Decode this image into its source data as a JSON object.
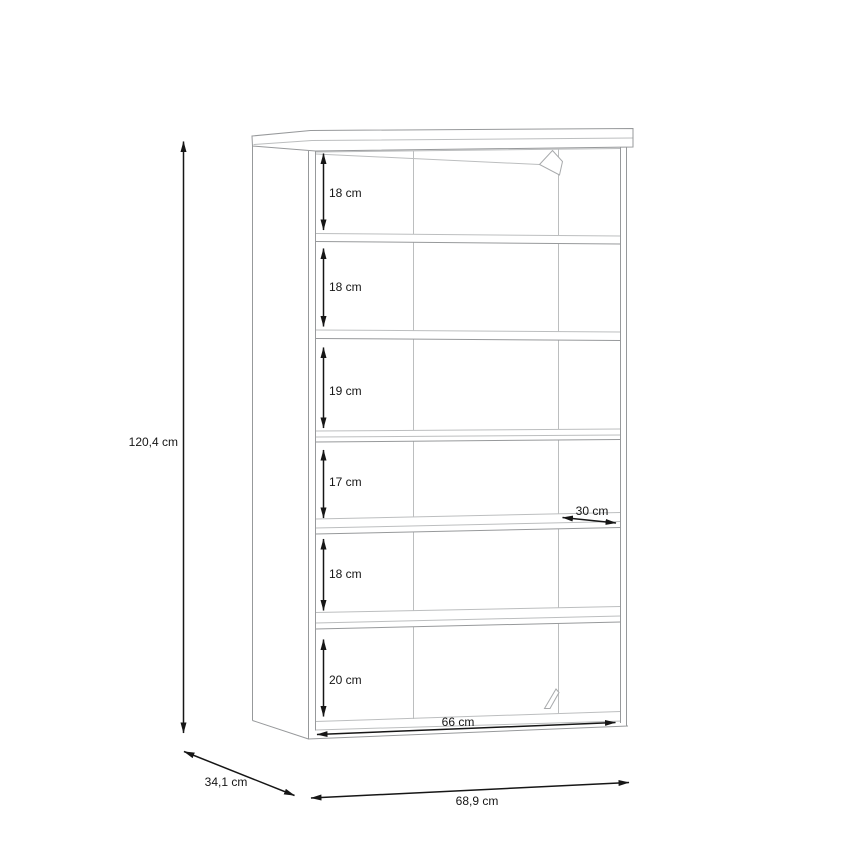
{
  "diagram": {
    "kind": "furniture-dimension-drawing",
    "item": "open-shelf-unit-6-compartments",
    "unit": "cm",
    "overall": {
      "height_label": "120,4 cm",
      "depth_label": "34,1 cm",
      "width_label": "68,9 cm"
    },
    "interior": {
      "width_label": "66 cm",
      "shelf_depth_label": "30 cm"
    },
    "compartment_heights": [
      "18 cm",
      "18 cm",
      "19 cm",
      "17 cm",
      "18 cm",
      "20 cm"
    ],
    "colors": {
      "furniture_line": "#97999b",
      "furniture_line_light": "#bcbebf",
      "dimension_line": "#161616",
      "background": "#ffffff"
    }
  }
}
